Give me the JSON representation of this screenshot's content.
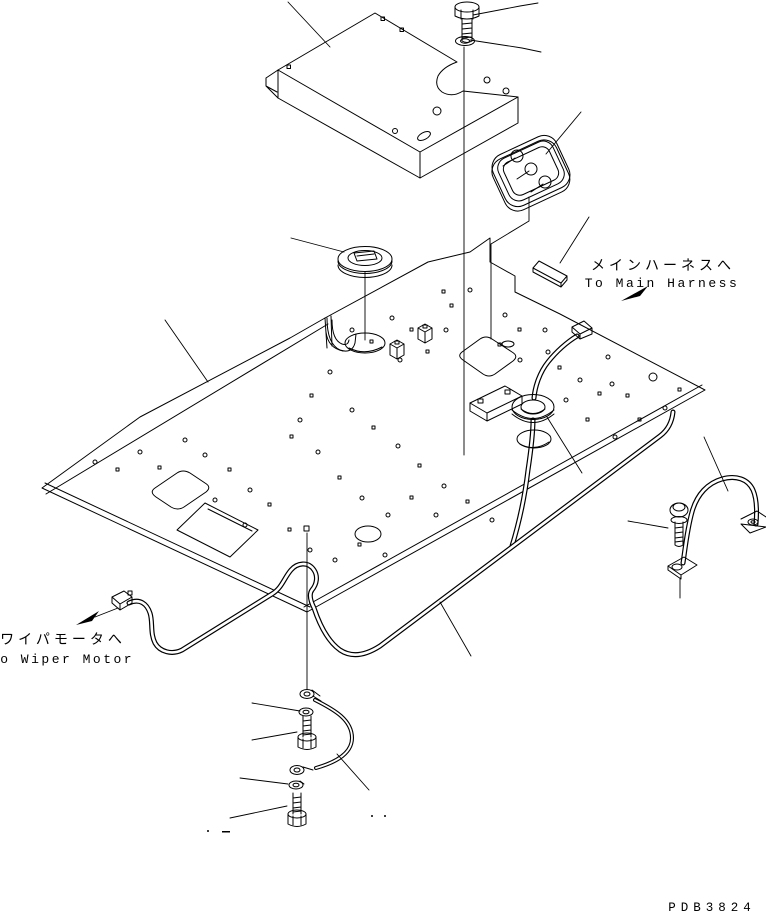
{
  "figure": {
    "type": "exploded-parts-diagram",
    "background": "#ffffff",
    "line_color": "#000000"
  },
  "labels": {
    "main_harness_jp": "メインハーネスへ",
    "main_harness_en": "To Main Harness",
    "wiper_motor_jp": "ワイパモータへ",
    "wiper_motor_en": "To Wiper Motor",
    "drawing_number": "PDB3824"
  },
  "parts": [
    {
      "name": "cover-panel"
    },
    {
      "name": "mounting-bolt-top"
    },
    {
      "name": "washer-top"
    },
    {
      "name": "room-lamp"
    },
    {
      "name": "harness-clip"
    },
    {
      "name": "grommet-cap"
    },
    {
      "name": "roof-panel"
    },
    {
      "name": "harness-grommet"
    },
    {
      "name": "wiring-harness"
    },
    {
      "name": "grab-handle"
    },
    {
      "name": "handle-bolt"
    },
    {
      "name": "ground-cable"
    },
    {
      "name": "washer-lower"
    },
    {
      "name": "ground-bolt-upper"
    },
    {
      "name": "spring-washer"
    },
    {
      "name": "ground-bolt-lower"
    }
  ]
}
